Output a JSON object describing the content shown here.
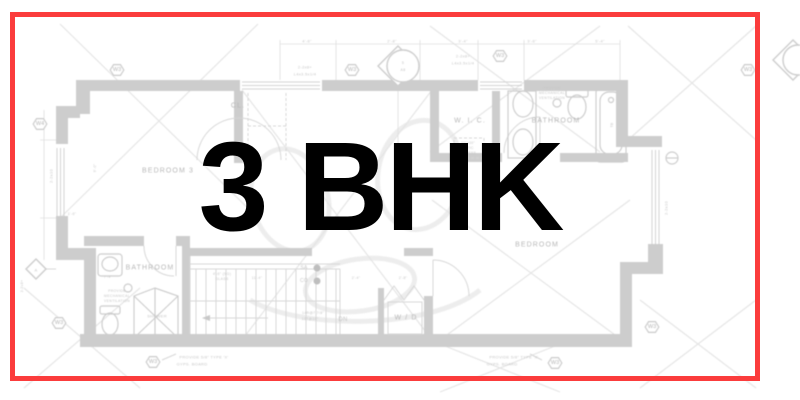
{
  "overlay": {
    "title": "3 BHK",
    "color": "#000000"
  },
  "frame": {
    "border_color": "#fb3c3c"
  },
  "floorplan": {
    "palette": {
      "wall": "#c9c9c9",
      "line": "#d4d4d4",
      "faint": "#e3e3e3",
      "label": "#b2b2b2",
      "tiny": "#c2c2c2",
      "watermark": "#ececec"
    },
    "room_labels": [
      {
        "text": "BEDROOM 3",
        "x": 168,
        "y": 171
      },
      {
        "text": "W. I. C.",
        "x": 470,
        "y": 121
      },
      {
        "text": "BATHROOM",
        "x": 556,
        "y": 121
      },
      {
        "text": "BATHROOM",
        "x": 150,
        "y": 268
      },
      {
        "text": "BEDROOM",
        "x": 537,
        "y": 245
      },
      {
        "text": "W / D",
        "x": 406,
        "y": 318
      },
      {
        "text": "CL.",
        "x": 238,
        "y": 106
      }
    ],
    "annotations": [
      {
        "text": "2-2x8+",
        "x": 305,
        "y": 67
      },
      {
        "text": "L4x3.5x1/4",
        "x": 305,
        "y": 74
      },
      {
        "text": "2-2x8+",
        "x": 463,
        "y": 56
      },
      {
        "text": "L4x3.5x1/4",
        "x": 463,
        "y": 63
      },
      {
        "text": "2-2x10",
        "x": 51,
        "y": 176,
        "rot": true
      },
      {
        "text": "2-2x10",
        "x": 666,
        "y": 208,
        "rot": true
      },
      {
        "text": "2-2x8+",
        "x": 22,
        "y": 286,
        "rot": true,
        "size": 3.5
      },
      {
        "text": "SA",
        "x": 304,
        "y": 268,
        "size": 5
      },
      {
        "text": "CO",
        "x": 304,
        "y": 281,
        "size": 5
      },
      {
        "text": "DN",
        "x": 343,
        "y": 320,
        "size": 6
      },
      {
        "text": "SHOWER",
        "x": 157,
        "y": 316
      },
      {
        "text": "14R@7 7/8\"",
        "x": 313,
        "y": 313,
        "size": 3.5
      },
      {
        "text": "13T@10\"",
        "x": 310,
        "y": 319,
        "size": 3.5
      },
      {
        "text": "PROVIDE",
        "x": 117,
        "y": 291,
        "size": 3.5
      },
      {
        "text": "MECHANICAL",
        "x": 117,
        "y": 296,
        "size": 3.5
      },
      {
        "text": "VENTILATION",
        "x": 117,
        "y": 301,
        "size": 3.5
      },
      {
        "text": "PROVIDE",
        "x": 552,
        "y": 88,
        "size": 3.5
      },
      {
        "text": "MECHANICAL",
        "x": 552,
        "y": 93,
        "size": 3.5
      },
      {
        "text": "VENTILATION",
        "x": 552,
        "y": 98,
        "size": 3.5
      },
      {
        "text": "PROVIDE 5/8\" TYPE 'X'",
        "x": 204,
        "y": 357
      },
      {
        "text": "GYPS. BOARD",
        "x": 192,
        "y": 364
      },
      {
        "text": "PROVIDE 5/8\" TYPE 'X'",
        "x": 514,
        "y": 357
      },
      {
        "text": "GYPS. BOARD",
        "x": 502,
        "y": 364
      },
      {
        "text": "22\"x30\"",
        "x": 468,
        "y": 143,
        "size": 3.5
      },
      {
        "text": "ATTIC",
        "x": 468,
        "y": 148,
        "size": 3.5
      },
      {
        "text": "ACCESS",
        "x": 468,
        "y": 153,
        "size": 3.5
      },
      {
        "text": "4'-6\"",
        "x": 307,
        "y": 41
      },
      {
        "text": "2'-8\"",
        "x": 392,
        "y": 41
      },
      {
        "text": "3'-4\"",
        "x": 463,
        "y": 41
      },
      {
        "text": "3'-6\"",
        "x": 532,
        "y": 41
      },
      {
        "text": "5'-4\"",
        "x": 600,
        "y": 41
      },
      {
        "text": "9'-0\"",
        "x": 95,
        "y": 168,
        "rot": true,
        "size": 3.5
      },
      {
        "text": "1'-6\"",
        "x": 72,
        "y": 214,
        "size": 3.5
      },
      {
        "text": "7'-4\"",
        "x": 108,
        "y": 277,
        "size": 3.5
      },
      {
        "text": "4'-6\" (SG)",
        "x": 222,
        "y": 274,
        "size": 3.5
      },
      {
        "text": "GLASS",
        "x": 222,
        "y": 279,
        "size": 3.5
      },
      {
        "text": "11'-4\"",
        "x": 257,
        "y": 278,
        "size": 3.5
      },
      {
        "text": "2'-4\"",
        "x": 356,
        "y": 278,
        "size": 3.5
      },
      {
        "text": "2'-8\"",
        "x": 403,
        "y": 278,
        "size": 3.5
      },
      {
        "text": "5",
        "x": 403,
        "y": 63,
        "size": 3.5
      },
      {
        "text": "A8",
        "x": 403,
        "y": 70,
        "size": 3.5
      },
      {
        "text": "A",
        "x": 36,
        "y": 270
      },
      {
        "text": "TB",
        "x": 612,
        "y": 125,
        "rot": true,
        "size": 3.5
      }
    ],
    "markers": [
      {
        "label": "W3",
        "x": 117,
        "y": 70
      },
      {
        "label": "W3",
        "x": 352,
        "y": 70
      },
      {
        "label": "W3",
        "x": 500,
        "y": 56
      },
      {
        "label": "W3",
        "x": 748,
        "y": 70
      },
      {
        "label": "W4",
        "x": 40,
        "y": 124
      },
      {
        "label": "W3",
        "x": 59,
        "y": 323
      },
      {
        "label": "W3",
        "x": 652,
        "y": 327
      },
      {
        "label": "W3",
        "x": 153,
        "y": 362
      },
      {
        "label": "W3",
        "x": 555,
        "y": 363
      }
    ],
    "dots": [
      {
        "x": 317,
        "y": 268
      },
      {
        "x": 317,
        "y": 281
      }
    ]
  }
}
